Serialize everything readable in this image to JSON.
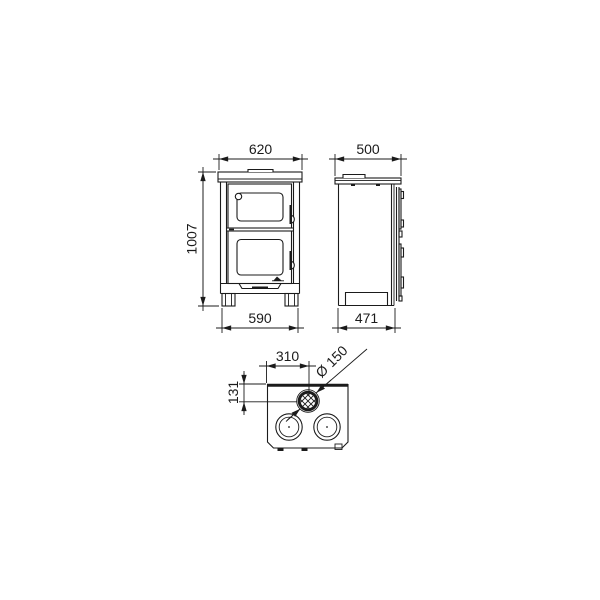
{
  "drawing": {
    "kind": "technical dimensional drawing of a wood-burning cooker stove, three orthographic views",
    "colors": {
      "line": "#1b1b1b",
      "background": "#ffffff"
    },
    "dimensions": {
      "front_top_width": "620",
      "front_height": "1007",
      "front_feet_width": "590",
      "side_top_depth": "500",
      "side_feet_depth": "471",
      "top_flue_offset_x": "310",
      "top_flue_offset_y": "131",
      "top_flue_diameter": "Ø 150"
    }
  }
}
